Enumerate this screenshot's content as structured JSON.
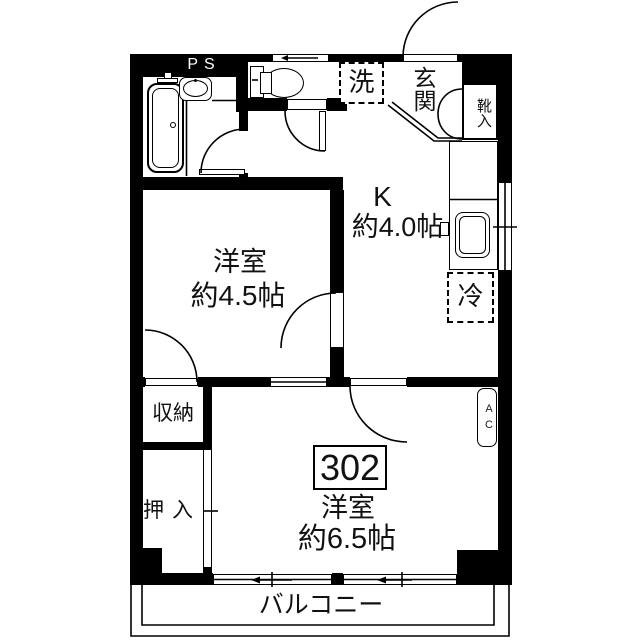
{
  "unit": {
    "number": "302"
  },
  "rooms": {
    "ps_label": "PS",
    "laundry_label": "洗",
    "entrance_label": "玄関",
    "shoe_label": "靴入",
    "kitchen_label": "K",
    "kitchen_size": "約4.0帖",
    "western_a_label": "洋室",
    "western_a_size": "約4.5帖",
    "fridge_label": "冷",
    "storage_label": "収納",
    "closet_label": "押入",
    "western_b_label": "洋室",
    "western_b_size": "約6.5帖",
    "balcony_label": "バルコニー",
    "ac_label": "AC"
  },
  "colors": {
    "wall": "#000000",
    "background": "#ffffff",
    "line": "#000000"
  }
}
